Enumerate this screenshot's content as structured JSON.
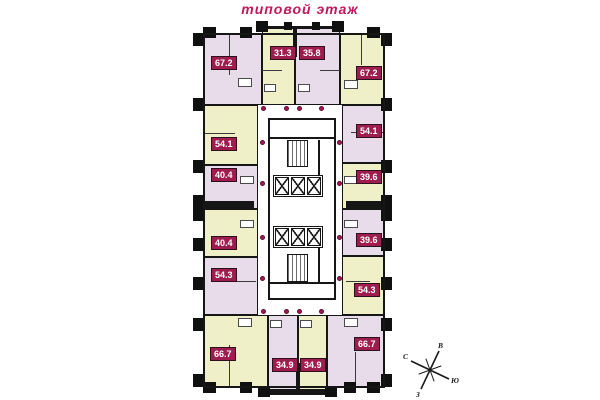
{
  "title": "типовой этаж",
  "colors": {
    "title_text": "#c2185b",
    "apartment_purple": "#e8dcea",
    "apartment_yellow": "#eff0c8",
    "badge_background": "#9e1c4e",
    "badge_text": "#ffffff",
    "wall": "#161616",
    "door_dot": "#ad1457",
    "corridor": "#ffffff"
  },
  "apartments": [
    {
      "id": "top-1",
      "area": "67.2",
      "fill": "purple"
    },
    {
      "id": "top-2",
      "area": "31.3",
      "fill": "yellow"
    },
    {
      "id": "top-3",
      "area": "35.8",
      "fill": "purple"
    },
    {
      "id": "top-4",
      "area": "67.2",
      "fill": "yellow"
    },
    {
      "id": "left-1",
      "area": "54.1",
      "fill": "yellow"
    },
    {
      "id": "left-2",
      "area": "40.4",
      "fill": "purple"
    },
    {
      "id": "left-3",
      "area": "40.4",
      "fill": "yellow"
    },
    {
      "id": "left-4",
      "area": "54.3",
      "fill": "purple"
    },
    {
      "id": "right-1",
      "area": "54.1",
      "fill": "purple"
    },
    {
      "id": "right-2",
      "area": "39.6",
      "fill": "yellow"
    },
    {
      "id": "right-3",
      "area": "39.6",
      "fill": "purple"
    },
    {
      "id": "right-4",
      "area": "54.3",
      "fill": "yellow"
    },
    {
      "id": "bottom-1",
      "area": "66.7",
      "fill": "yellow"
    },
    {
      "id": "bottom-2",
      "area": "34.9",
      "fill": "purple"
    },
    {
      "id": "bottom-3",
      "area": "34.9",
      "fill": "yellow"
    },
    {
      "id": "bottom-4",
      "area": "66.7",
      "fill": "purple"
    }
  ],
  "compass": {
    "north": "С",
    "east": "В",
    "south": "Ю",
    "west": "З"
  }
}
